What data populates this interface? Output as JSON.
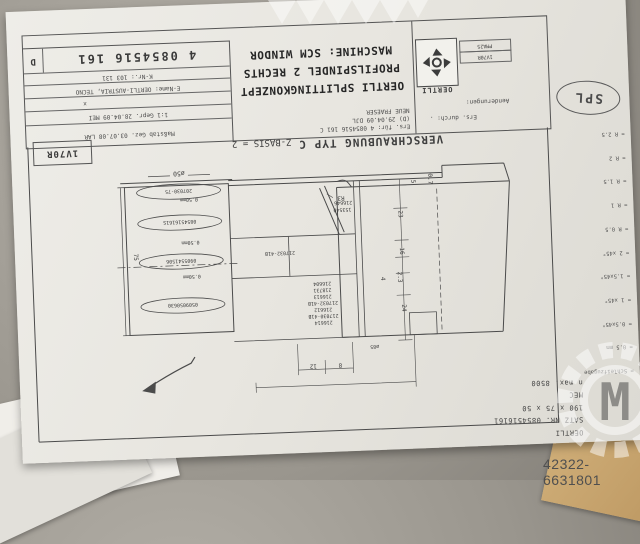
{
  "watermark": {
    "listing_id": "42322-6631801",
    "logo_letter": "M"
  },
  "title_block": {
    "doc_number": "4 0854516 161",
    "revision": "D",
    "k_nr": "K-Nr.: 103 131",
    "e_name": "E-Name: OERTLI-AUSTRIA, TECNO",
    "x_mark": "x",
    "row_gepr": "1:1   Gepr. 28.04.09   MEI",
    "row_gez": "Maßstab   Gez. 03.07.08   LAR",
    "title_lines": [
      "OERTLI SPLITTINGKONZEPT",
      "PROFILSPINDEL 2 RECHTS",
      "MASCHINE: SCM WINDOR"
    ],
    "aenderungen_label": "Aenderungen:",
    "change_note": "NEUE FRAESER",
    "change_date": "(D) 29.04.09 DJL",
    "ers_fuer": "Ers. für: 4 0854516 161 C",
    "ers_durch": "Ers. durch: .",
    "brand": "OERTLI",
    "field_boxes": [
      "PMA25",
      "1V70R"
    ]
  },
  "page_code": "1V70R",
  "stamp": "SPL",
  "legend": {
    "lines": [
      "= Schleifzugabe",
      "= 0.5 mm",
      "= 0.5x45°",
      "= 1 x45°",
      "= 1.5x45°",
      "= 2 x45°",
      "= R 0.5",
      "= R 1",
      "= R 1.5",
      "= R 2",
      "= R 2.5"
    ]
  },
  "drawing": {
    "caption": "VERSCHRAUBUNG TYP C",
    "z_basis": "Z-BASIS = 2",
    "dia_label": "ø50",
    "len_label": "75",
    "spindle_parts": [
      "207030-75",
      "0854516161S",
      "0905541506",
      "0509050630"
    ],
    "spacer": "0.50mm",
    "upper_part": "217032-41B",
    "pair_parts": [
      "216646",
      "153540"
    ],
    "radius": "R3",
    "parts_list": [
      "216604",
      "218731",
      "216613",
      "217032-41B",
      "216612",
      "217030-41B",
      "216614"
    ],
    "dims_right": [
      "0.7",
      "5",
      "23",
      "16",
      "2.3",
      "4",
      "24"
    ],
    "dims_bottom": [
      "12",
      "8"
    ],
    "hub_dia": "ø85"
  },
  "info_block": {
    "lines": [
      "OERTLI",
      "SATZ NR. 0854516161",
      "190 x 75 x 50",
      "MEC",
      "n max. 8500"
    ]
  }
}
